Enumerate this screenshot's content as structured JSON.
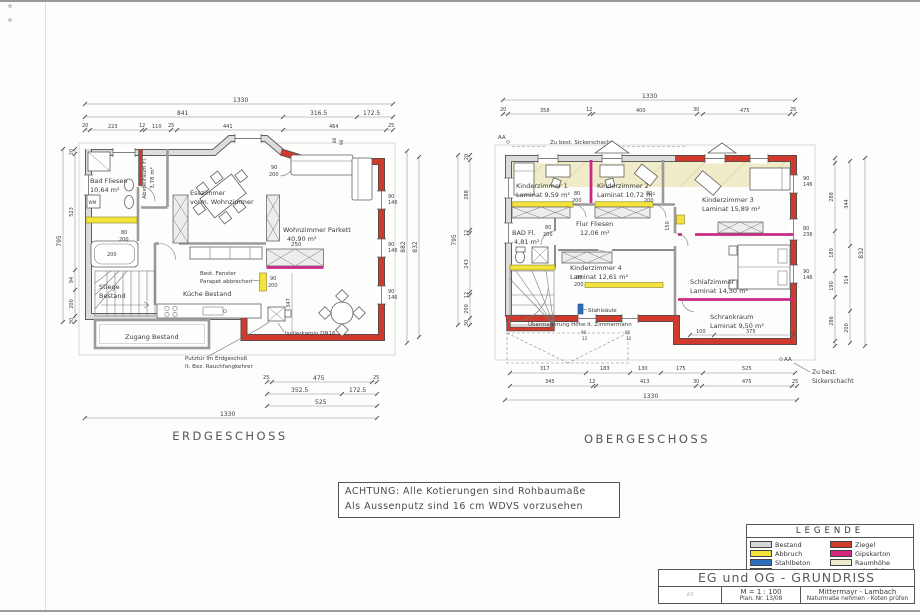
{
  "achtung": {
    "line1": "ACHTUNG: Alle Kotierungen sind Rohbaumaße",
    "line2": "Als Aussenputz sind 16 cm WDVS vorzusehen"
  },
  "eg": {
    "label": "ERDGESCHOSS",
    "rooms": {
      "bad1": "Bad Fliesen",
      "bad2": "10,64 m²",
      "abst1": "Abstellraum Fl.",
      "abst2": "3,78 m²",
      "ess1": "Esszimmer",
      "ess2": "vorm. Wohnzimmer",
      "wohn1": "Wohnzimmer Parkett",
      "wohn2": "40,90 m²",
      "kueche": "Küche Bestand",
      "stiege1": "Stiege",
      "stiege2": "Bestand",
      "zugang": "Zugang Bestand",
      "wm": "WM"
    },
    "notes": {
      "fen1": "Best. Fenster",
      "fen2": "Parapet abbrechen",
      "putz1": "Putztür im Erdgeschoß",
      "putz2": "lt. Bez. Rauchfangkehrer",
      "kamin": "Isolierkamin DN16"
    },
    "d": {
      "t1330": "1330",
      "t841": "841",
      "t3165": "316.5",
      "t1725": "172.5",
      "r3": [
        "20",
        "223",
        "12",
        "110",
        "25",
        "441",
        "464",
        "25"
      ],
      "l795": "795",
      "lc": [
        "20",
        "523",
        "94",
        "200",
        "30"
      ],
      "r882": "882",
      "r832": "832",
      "w90": "90",
      "w146": "146",
      "b25": "25",
      "b475": "475",
      "b3525": "352.5",
      "b1725": "172.5",
      "b525": "525",
      "b1330": "1330",
      "i250": "250",
      "i347": "347",
      "tub200": "200",
      "d80": "80",
      "d200": "200",
      "d90": "90"
    }
  },
  "og": {
    "label": "OBERGESCHOSS",
    "rooms": {
      "k11": "Kinderzimmer 1",
      "k12": "Laminat 9,59 m²",
      "k21": "Kinderzimmer 2",
      "k22": "Laminat 10,72 m²",
      "k31": "Kinderzimmer 3",
      "k32": "Laminat 15,89 m²",
      "k41": "Kinderzimmer 4",
      "k42": "Laminat 12,61 m²",
      "bad1": "BAD Fl.",
      "bad2": "4,81 m²",
      "flur1": "Flur Fliesen",
      "flur2": "12,06 m²",
      "schlaf1": "Schlafzimmer",
      "schlaf2": "Laminat 14,30 m²",
      "schrank1": "Schrankraum",
      "schrank2": "Laminat 9,50 m²"
    },
    "notes": {
      "sicker_top": "Zu best. Sickerschacht",
      "sicker_b1": "Zu best.",
      "sicker_b2": "Sickerschacht",
      "stahl": "Stahlsäule",
      "ueberm": "Übermauerung Höhe lt. Zimmermann",
      "aa": "AA"
    },
    "d": {
      "t1330": "1330",
      "r2": [
        "20",
        "358",
        "12",
        "400",
        "30",
        "475",
        "25"
      ],
      "l795": "795",
      "lc": [
        "20",
        "288",
        "12",
        "243",
        "12",
        "200",
        "30"
      ],
      "rc1": [
        "288",
        "180",
        "190",
        "286"
      ],
      "rc2": [
        "344",
        "314",
        "200"
      ],
      "r832": "832",
      "w90": "90",
      "w146": "146",
      "w80": "80",
      "w236": "236",
      "b1": [
        "317",
        "183",
        "130",
        "175",
        "525"
      ],
      "b2": [
        "345",
        "12",
        "413",
        "30",
        "475",
        "25"
      ],
      "b1330": "1330",
      "s100": "100",
      "s375": "375",
      "f150": "150",
      "d80": "80",
      "d200": "200",
      "bw90": "90",
      "bw12": "12"
    }
  },
  "legend": {
    "title": "LEGENDE",
    "col1": [
      {
        "label": "Bestand",
        "color": "#d8d8d8"
      },
      {
        "label": "Abbruch",
        "color": "#f3e33b"
      },
      {
        "label": "Stahlbeton",
        "color": "#2e6cc0"
      },
      {
        "label": "Holz",
        "color": "#d28a2e"
      }
    ],
    "col2": [
      {
        "label": "Ziegel",
        "color": "#cf3a2a"
      },
      {
        "label": "Gipskarton",
        "color": "#d4267f"
      },
      {
        "label": "Raumhöhe",
        "color": "#efe9cd"
      }
    ],
    "raumhoehe2": "unter 2,0 m"
  },
  "titleblock": {
    "format": "A3",
    "title": "EG und OG  -  GRUNDRISS",
    "scale": "M = 1 : 100",
    "plan_nr": "Plan. Nr. 13/08",
    "client": "Mittermayr - Lambach",
    "note": "Naturmaße nehmen - Koten prüfen"
  }
}
